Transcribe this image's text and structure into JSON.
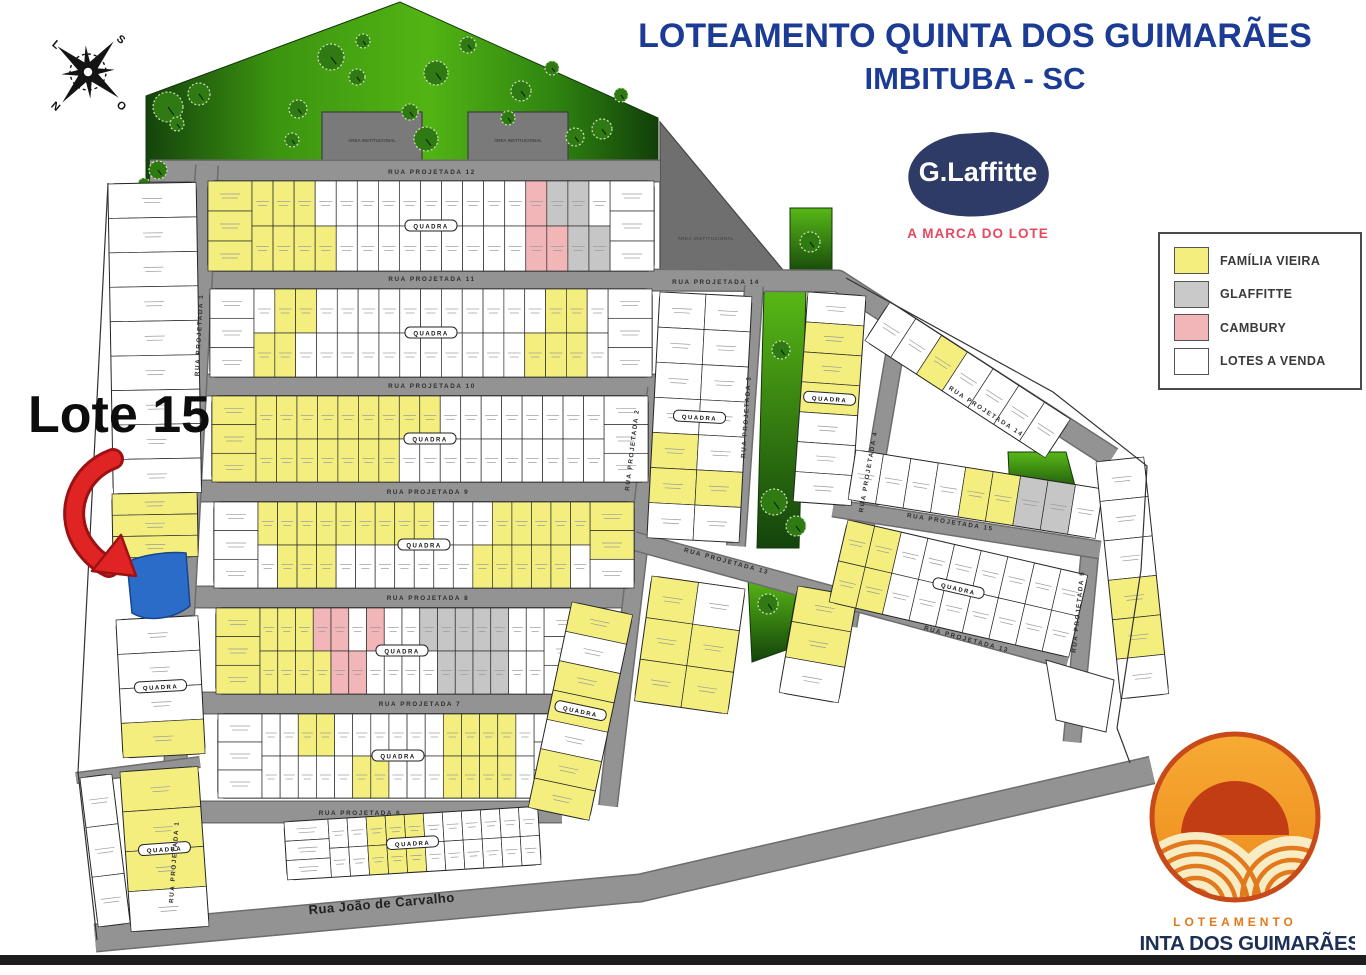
{
  "title": {
    "line1": "LOTEAMENTO QUINTA DOS GUIMARÃES",
    "line2": "IMBITUBA - SC"
  },
  "brand": {
    "name": "G.Laffitte",
    "tagline": "A MARCA DO LOTE"
  },
  "legend": {
    "items": [
      {
        "label": "FAMÍLIA VIEIRA",
        "color": "#f3ee7e"
      },
      {
        "label": "GLAFFITTE",
        "color": "#c9c9c9"
      },
      {
        "label": "CAMBURY",
        "color": "#f2b6b9"
      },
      {
        "label": "LOTES A VENDA",
        "color": "#ffffff"
      }
    ]
  },
  "compass": {
    "n": "N",
    "s": "S",
    "l": "L",
    "o": "O"
  },
  "callout": {
    "label": "Lote 15",
    "highlight_color": "#2a6cc8",
    "arrow_color": "#e02424",
    "arrow_dark": "#9c1212"
  },
  "footer_logo": {
    "line1": "LOTEAMENTO",
    "line2": "QUINTA DOS GUIMARÃES"
  },
  "colors": {
    "title_navy": "#1c3b94",
    "brand_navy": "#2e3b66",
    "tagline_red": "#e8485f",
    "road_fill": "#939393",
    "road_edge": "#6d6d6d",
    "block_stroke": "#1c1c1c",
    "lot_Y": "#f3ee7e",
    "lot_W": "#ffffff",
    "lot_P": "#f2b6b9",
    "lot_G": "#c6c6c6",
    "lot_B": "#2a6cc8",
    "institutional": "#6f6f6f",
    "building": "#7a7a7a",
    "green_dark": "#14430c",
    "green_bright": "#52b414",
    "logo_orange": "#ee8a1e",
    "logo_ring": "#c84a1a",
    "logo_sun": "#c23d14",
    "logo_cream": "#f8ecc4",
    "footer_navy": "#1c2f55",
    "footer_orange": "#e2791c"
  },
  "map": {
    "institutional": {
      "pts": [
        [
          660,
          122
        ],
        [
          788,
          276
        ],
        [
          660,
          276
        ]
      ],
      "label": "ÁREA INSTITUCIONAL",
      "lx": 706,
      "ly": 240
    },
    "buildings": [
      {
        "x": 322,
        "y": 112,
        "w": 100,
        "h": 56,
        "label": "ÁREA INSTITUCIONAL"
      },
      {
        "x": 468,
        "y": 112,
        "w": 100,
        "h": 56,
        "label": "ÁREA INSTITUCIONAL"
      }
    ],
    "greens": [
      {
        "pts": [
          [
            146,
            186
          ],
          [
            146,
            96
          ],
          [
            400,
            2
          ],
          [
            658,
            118
          ],
          [
            658,
            170
          ],
          [
            207,
            170
          ]
        ],
        "fill": "gTop"
      },
      {
        "pts": [
          [
            790,
            208
          ],
          [
            832,
            208
          ],
          [
            832,
            276
          ],
          [
            790,
            276
          ]
        ],
        "fill": "gStrip"
      },
      {
        "pts": [
          [
            764,
            290
          ],
          [
            806,
            290
          ],
          [
            799,
            548
          ],
          [
            757,
            548
          ]
        ],
        "fill": "gStrip"
      },
      {
        "pts": [
          [
            748,
            578
          ],
          [
            798,
            584
          ],
          [
            786,
            650
          ],
          [
            752,
            662
          ]
        ],
        "fill": "gStrip"
      },
      {
        "pts": [
          [
            1008,
            452
          ],
          [
            1066,
            452
          ],
          [
            1078,
            497
          ],
          [
            1010,
            492
          ]
        ],
        "fill": "gStrip"
      }
    ],
    "trees": [
      [
        168,
        107,
        15
      ],
      [
        199,
        94,
        11
      ],
      [
        177,
        124,
        7
      ],
      [
        298,
        109,
        9
      ],
      [
        331,
        57,
        13
      ],
      [
        357,
        77,
        8
      ],
      [
        363,
        41,
        7
      ],
      [
        436,
        73,
        12
      ],
      [
        468,
        45,
        8
      ],
      [
        426,
        139,
        12
      ],
      [
        410,
        112,
        8
      ],
      [
        521,
        91,
        10
      ],
      [
        575,
        137,
        9
      ],
      [
        602,
        129,
        10
      ],
      [
        621,
        95,
        7
      ],
      [
        292,
        140,
        7
      ],
      [
        158,
        170,
        9
      ],
      [
        144,
        184,
        6
      ],
      [
        508,
        118,
        7
      ],
      [
        552,
        68,
        7
      ],
      [
        810,
        242,
        10
      ],
      [
        781,
        350,
        9
      ],
      [
        774,
        502,
        13
      ],
      [
        796,
        526,
        10
      ],
      [
        768,
        604,
        10
      ]
    ],
    "roads": [
      {
        "pts": [
          [
            150,
            171
          ],
          [
            660,
            171
          ]
        ],
        "w": 20
      },
      {
        "pts": [
          [
            193,
            278
          ],
          [
            838,
            281
          ],
          [
            1112,
            458
          ]
        ],
        "w": 20
      },
      {
        "pts": [
          [
            192,
            385
          ],
          [
            740,
            385
          ]
        ],
        "w": 20
      },
      {
        "pts": [
          [
            190,
            491
          ],
          [
            650,
            491
          ]
        ],
        "w": 20
      },
      {
        "pts": [
          [
            187,
            597
          ],
          [
            638,
            597
          ]
        ],
        "w": 20
      },
      {
        "pts": [
          [
            184,
            703
          ],
          [
            602,
            703
          ]
        ],
        "w": 20
      },
      {
        "pts": [
          [
            181,
            812
          ],
          [
            562,
            812
          ]
        ],
        "w": 20
      },
      {
        "pts": [
          [
            207,
            165
          ],
          [
            166,
            940
          ]
        ],
        "w": 21
      },
      {
        "pts": [
          [
            657,
            388
          ],
          [
            608,
            806
          ]
        ],
        "w": 17
      },
      {
        "pts": [
          [
            754,
            286
          ],
          [
            736,
            546
          ]
        ],
        "w": 17
      },
      {
        "pts": [
          [
            898,
            334
          ],
          [
            848,
            626
          ]
        ],
        "w": 16
      },
      {
        "pts": [
          [
            1090,
            552
          ],
          [
            1072,
            742
          ]
        ],
        "w": 16
      },
      {
        "pts": [
          [
            634,
            541
          ],
          [
            1068,
            660
          ]
        ],
        "w": 17
      },
      {
        "pts": [
          [
            833,
            508
          ],
          [
            1100,
            550
          ]
        ],
        "w": 16
      },
      {
        "pts": [
          [
            95,
            938
          ],
          [
            640,
            888
          ],
          [
            1152,
            770
          ]
        ],
        "w": 26
      },
      {
        "pts": [
          [
            76,
            778
          ],
          [
            200,
            762
          ]
        ],
        "w": 9
      }
    ],
    "blocks": [
      {
        "x": 208,
        "y": 181,
        "w": 446,
        "h": 90,
        "capL": "YYY",
        "capR": "WWW",
        "rows": [
          "YYYWWWWWWWWWWPGGW",
          "YYYYWWWWWWWWWPPGG"
        ],
        "label": "QUADRA"
      },
      {
        "x": 210,
        "y": 289,
        "w": 442,
        "h": 88,
        "capL": "WWW",
        "capR": "WWW",
        "rows": [
          "WYYWWWWWWWWWWWYYW",
          "YYWWWWWWWWWWWYYYW"
        ],
        "label": "QUADRA"
      },
      {
        "x": 212,
        "y": 396,
        "w": 436,
        "h": 86,
        "capL": "YYY",
        "capR": "WWW",
        "rows": [
          "YYYYYYYYYWWWWWWWW",
          "YYYYYYYWWWWWWWWWW"
        ],
        "label": "QUADRA"
      },
      {
        "x": 214,
        "y": 502,
        "w": 420,
        "h": 86,
        "capL": "WWW",
        "capR": "YYW",
        "rows": [
          "YYYYYYYYYWWWYYYYY",
          "WYYYWWWWWWWYYYYYW"
        ],
        "label": "QUADRA"
      },
      {
        "x": 216,
        "y": 608,
        "w": 372,
        "h": 86,
        "capL": "YYY",
        "capR": "WWW",
        "rows": [
          "YYYPPWPWWGGGGGWW",
          "YYYYPPWWWWGGGGWW"
        ],
        "label": "QUADRA"
      },
      {
        "x": 218,
        "y": 714,
        "w": 360,
        "h": 84,
        "capL": "WWW",
        "capR": "WWW",
        "rows": [
          "WWYYWWWWWWYYYYW",
          "WWWWWYYWWWYYYYW"
        ],
        "label": "QUADRA"
      },
      {
        "x": 284,
        "y": 822,
        "w": 254,
        "h": 58,
        "rot": -3.5,
        "capL": "WWW",
        "rows": [
          "WWYYYWWWWWW",
          "WWYYYWWWWWW"
        ],
        "label": "QUADRA"
      },
      {
        "x": 108,
        "y": 184,
        "w": 88,
        "h": 310,
        "rot": -1,
        "vertical": true,
        "rows": [
          "WWWWWWWWW"
        ]
      },
      {
        "x": 112,
        "y": 494,
        "w": 85,
        "h": 64,
        "rot": -1,
        "vertical": true,
        "rows": [
          "YYY"
        ]
      },
      {
        "x": 116,
        "y": 620,
        "w": 82,
        "h": 138,
        "rot": -3,
        "vertical": true,
        "rows": [
          "WWWY"
        ],
        "label": "QUADRA"
      },
      {
        "x": 120,
        "y": 772,
        "w": 78,
        "h": 160,
        "rot": -4,
        "vertical": true,
        "rows": [
          "YYYW"
        ],
        "label": "QUADRA"
      },
      {
        "x": 80,
        "y": 778,
        "w": 32,
        "h": 150,
        "rot": -7,
        "vertical": true,
        "rows": [
          "WWW"
        ]
      },
      {
        "x": 572,
        "y": 602,
        "w": 62,
        "h": 210,
        "rot": 12,
        "vertical": true,
        "rows": [
          "YWYYWYY"
        ],
        "label": "QUADRA"
      },
      {
        "x": 660,
        "y": 292,
        "w": 92,
        "h": 246,
        "rot": 3,
        "vertical": true,
        "rows": [
          "WWWWYYW",
          "WWWWWYW"
        ],
        "label": "QUADRA"
      },
      {
        "x": 652,
        "y": 576,
        "w": 94,
        "h": 126,
        "rot": 8,
        "vertical": true,
        "rows": [
          "YYY",
          "WYY"
        ]
      },
      {
        "x": 808,
        "y": 292,
        "w": 58,
        "h": 210,
        "rot": 4,
        "vertical": true,
        "rows": [
          "WYYYWWW"
        ],
        "label": "QUADRA"
      },
      {
        "x": 798,
        "y": 586,
        "w": 60,
        "h": 108,
        "rot": 10,
        "vertical": true,
        "rows": [
          "YYW"
        ]
      },
      {
        "x": 890,
        "y": 302,
        "w": 215,
        "h": 46,
        "rot": 33,
        "rows": [
          "WWYWWWW"
        ]
      },
      {
        "x": 856,
        "y": 450,
        "w": 250,
        "h": 50,
        "rot": 9,
        "rows": [
          "WWWWYYGGW"
        ]
      },
      {
        "x": 848,
        "y": 520,
        "w": 246,
        "h": 84,
        "rot": 13,
        "rows": [
          "YYWWWWWWW",
          "YYWWWWWWW"
        ],
        "label": "QUADRA"
      },
      {
        "x": 1096,
        "y": 462,
        "w": 48,
        "h": 238,
        "rot": -6,
        "vertical": true,
        "rows": [
          "WWWYYW"
        ]
      }
    ],
    "extra_polys": [
      {
        "pts": [
          [
            1046,
            660
          ],
          [
            1114,
            680
          ],
          [
            1106,
            732
          ],
          [
            1056,
            720
          ]
        ]
      }
    ],
    "boundaries": [
      {
        "pts": [
          [
            108,
            183
          ],
          [
            78,
            772
          ],
          [
            97,
            940
          ]
        ]
      },
      {
        "pts": [
          [
            846,
            278
          ],
          [
            1053,
            392
          ],
          [
            1147,
            466
          ],
          [
            1141,
            570
          ],
          [
            1117,
            728
          ],
          [
            1130,
            763
          ]
        ]
      }
    ],
    "lote15_path": "M127,562 C142,555 168,551 186,553 L190,606 C172,620 147,622 132,613 Z",
    "labels": [
      {
        "t": "RUA  PROJETADA  12",
        "x": 432,
        "y": 174,
        "r": 0
      },
      {
        "t": "RUA  PROJETADA  11",
        "x": 432,
        "y": 281,
        "r": 0
      },
      {
        "t": "RUA  PROJETADA  10",
        "x": 432,
        "y": 388,
        "r": 0
      },
      {
        "t": "RUA  PROJETADA  9",
        "x": 428,
        "y": 494,
        "r": 0
      },
      {
        "t": "RUA  PROJETADA  8",
        "x": 428,
        "y": 600,
        "r": 0
      },
      {
        "t": "RUA  PROJETADA  7",
        "x": 420,
        "y": 706,
        "r": 0
      },
      {
        "t": "RUA  PROJETADA  6",
        "x": 360,
        "y": 815,
        "r": 0
      },
      {
        "t": "RUA  PROJETADA  1",
        "x": 201,
        "y": 335,
        "r": -87
      },
      {
        "t": "RUA  PROJETADA  1",
        "x": 176,
        "y": 862,
        "r": -86
      },
      {
        "t": "RUA  PROJETADA  14",
        "x": 716,
        "y": 284,
        "r": 0
      },
      {
        "t": "RUA  PROJETADA  14",
        "x": 985,
        "y": 413,
        "r": 33
      },
      {
        "t": "RUA  PROJETADA  2",
        "x": 634,
        "y": 450,
        "r": -83
      },
      {
        "t": "RUA  PROJETADA  3",
        "x": 748,
        "y": 417,
        "r": -86
      },
      {
        "t": "RUA  PROJETADA  4",
        "x": 870,
        "y": 472,
        "r": -80
      },
      {
        "t": "RUA  PROJETADA  15",
        "x": 950,
        "y": 524,
        "r": 9
      },
      {
        "t": "RUA  PROJETADA  13",
        "x": 726,
        "y": 563,
        "r": 15
      },
      {
        "t": "RUA  PROJETADA  13",
        "x": 966,
        "y": 641,
        "r": 15
      },
      {
        "t": "RUA  PROJETADA  5",
        "x": 1080,
        "y": 612,
        "r": -84
      },
      {
        "t": "Rua João de Carvalho",
        "x": 382,
        "y": 908,
        "r": -5,
        "s": 13,
        "c": "#1f1f1f",
        "ls": 0.5
      }
    ]
  }
}
